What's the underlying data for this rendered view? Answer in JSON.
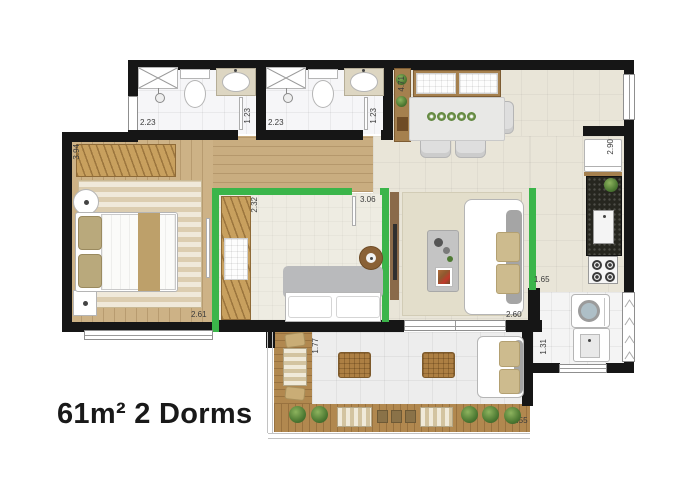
{
  "title": "61m² 2 Dorms",
  "dims": {
    "bath1_w": "2.23",
    "bath1_d": "1.23",
    "bath2_w": "2.23",
    "bath2_d": "1.23",
    "bed1_d": "3.94",
    "bed1_w": "2.61",
    "bed2_d": "2.32",
    "bed2_w": "3.06",
    "dining_d": "4.71",
    "kitchen_d": "2.90",
    "living_d": "1.65",
    "living_w": "2.60",
    "service_d": "1.31",
    "balcony_d": "1.77",
    "balcony_w": "4.55"
  },
  "colors": {
    "highlight_green": "#3bb54a",
    "wall": "#161616",
    "wood_floor": "#cdb286",
    "deck_wood": "#b1884f",
    "tile_beige": "#e9e5d8",
    "counter_black": "#26261f"
  }
}
